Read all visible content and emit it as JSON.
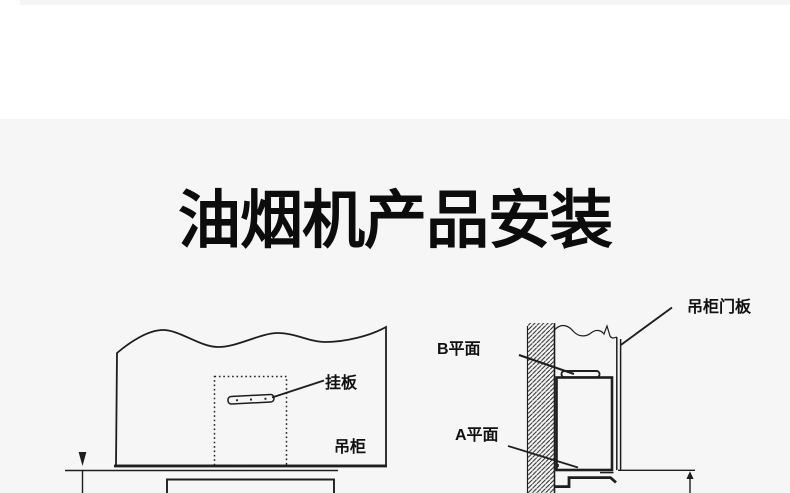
{
  "title": {
    "text": "油烟机产品安装"
  },
  "colors": {
    "panel_background": "#f6f6f7",
    "line": "#1e1e1e",
    "title": "#0c0c0c",
    "top_strip": "#f5f4f7"
  },
  "left_diagram": {
    "labels": {
      "hanging_plate": "挂板",
      "cabinet": "吊柜"
    }
  },
  "right_diagram": {
    "labels": {
      "plane_b": "B平面",
      "plane_a": "A平面",
      "cabinet_door_panel": "吊柜门板"
    }
  }
}
